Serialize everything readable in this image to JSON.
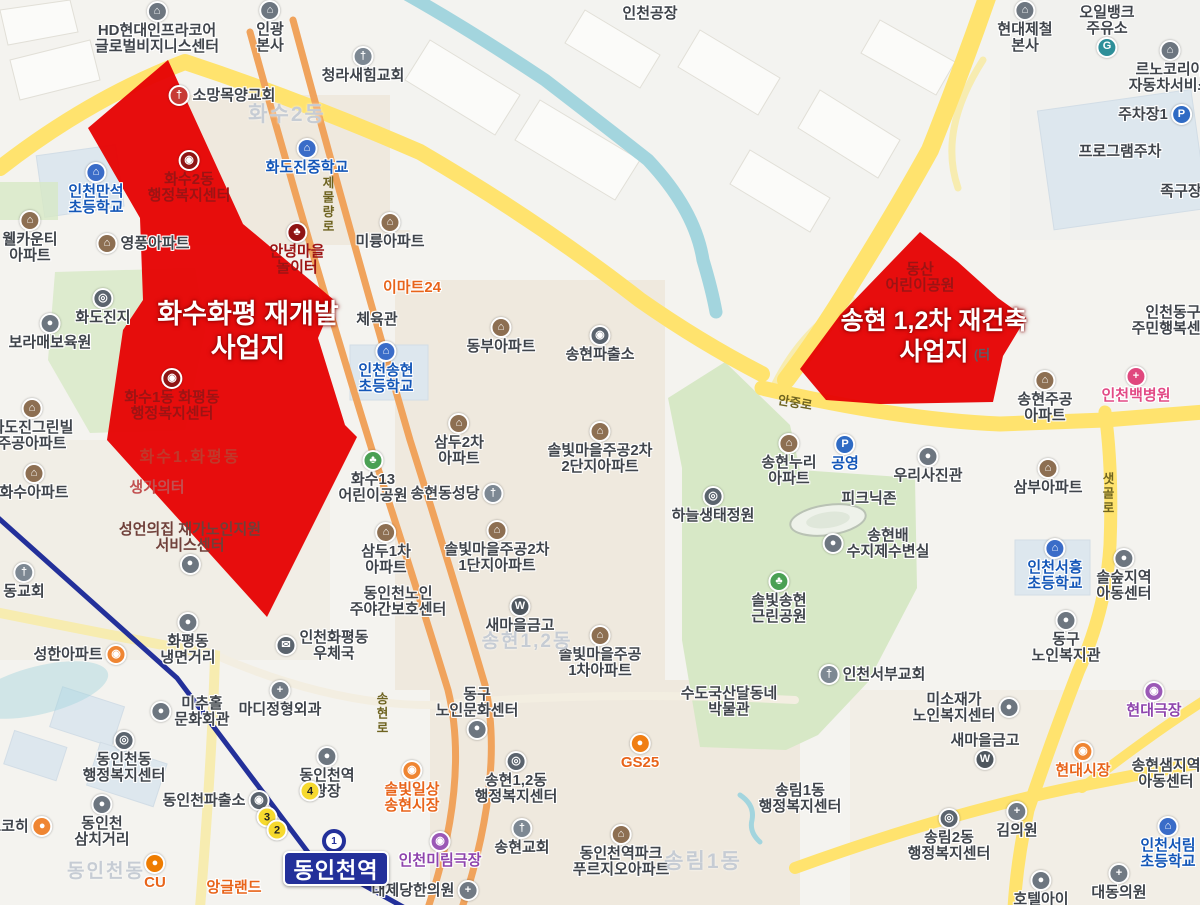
{
  "theme": {
    "zone_red": "#e60505",
    "road_main": "#ffe36e",
    "road_ramp": "#f7ecb0",
    "railway_orange": "#f0a35c",
    "subway_navy": "#23309a",
    "water": "#a3d5de",
    "park": "#d7e8c6"
  },
  "zones": [
    {
      "id": "hwasu-hwapyeong",
      "title_lines": [
        "화수화평 재개발",
        "사업지"
      ],
      "x": 248,
      "y": 298,
      "size": 27
    },
    {
      "id": "songhyeon-12",
      "title_lines": [
        "송현 1,2차 재건축",
        "사업지"
      ],
      "x": 934,
      "y": 306,
      "size": 25
    }
  ],
  "station": {
    "label": "동인천역",
    "line_mark": "1"
  },
  "subway_exits": [
    {
      "n": "4",
      "x": 310,
      "y": 791
    },
    {
      "n": "3",
      "x": 267,
      "y": 817
    },
    {
      "n": "2",
      "x": 277,
      "y": 830
    }
  ],
  "districts": [
    {
      "t": "화수2동",
      "x": 287,
      "y": 98,
      "s": 21
    },
    {
      "t": "송현1,2동",
      "x": 527,
      "y": 626,
      "s": 19
    },
    {
      "t": "송림1동",
      "x": 703,
      "y": 845,
      "s": 21
    },
    {
      "t": "동인천동",
      "x": 106,
      "y": 856,
      "s": 19
    },
    {
      "t": "화수1.화평동",
      "x": 190,
      "y": 443,
      "s": 16,
      "onred": true
    }
  ],
  "road_labels": [
    {
      "t": "제물량로",
      "x": 318,
      "y": 176,
      "v": 1
    },
    {
      "t": "안중로",
      "x": 778,
      "y": 392,
      "r": 10
    },
    {
      "t": "샛골로",
      "x": 1098,
      "y": 472,
      "v": 1
    },
    {
      "t": "송현로",
      "x": 372,
      "y": 692,
      "v": 1
    }
  ],
  "icons": {
    "apt": {
      "bg": "#8d6f52",
      "g": "⌂"
    },
    "sch": {
      "bg": "#3a6cc8",
      "g": "⌂"
    },
    "chu": {
      "bg": "#7d8893",
      "g": "†"
    },
    "chur": {
      "bg": "#c73a35",
      "g": "†"
    },
    "gov": {
      "bg": "#5b646e",
      "g": "◎"
    },
    "govr": {
      "bg": "#8f1414",
      "g": "◉"
    },
    "par": {
      "bg": "#4aa054",
      "g": "♣"
    },
    "parr": {
      "bg": "#8f1414",
      "g": "♣"
    },
    "pol": {
      "bg": "#5b646e",
      "g": "◉"
    },
    "hos": {
      "bg": "#717a84",
      "g": "+"
    },
    "hosp": {
      "bg": "#e0487e",
      "g": "+"
    },
    "pk": {
      "bg": "#2f6bc4",
      "g": "P"
    },
    "w": {
      "bg": "#4e565e",
      "g": "W"
    },
    "mkt": {
      "bg": "#ef8532",
      "g": "◉"
    },
    "thr": {
      "bg": "#9b59b6",
      "g": "◉"
    },
    "gas": {
      "bg": "#2e8f99",
      "g": "G"
    },
    "biz": {
      "bg": "#6d7680",
      "g": "⌂"
    },
    "dot": {
      "bg": "#6d7680",
      "g": "●"
    },
    "post": {
      "bg": "#5b646e",
      "g": "✉"
    },
    "cofe": {
      "bg": "#ef8532",
      "g": "●"
    },
    "cu": {
      "bg": "#ee7c00",
      "g": "●"
    },
    "gs": {
      "bg": "#f07e13",
      "g": "●"
    }
  },
  "pois": [
    {
      "t": [
        "HD현대인프라코어",
        "글로벌비지니스센터"
      ],
      "x": 157,
      "y": 1,
      "c": "d",
      "i": "biz",
      "p": "t"
    },
    {
      "t": [
        "인광",
        "본사"
      ],
      "x": 270,
      "y": 0,
      "c": "d",
      "i": "biz",
      "p": "t"
    },
    {
      "t": [
        "청라새힘교회"
      ],
      "x": 363,
      "y": 46,
      "c": "d",
      "i": "chu",
      "p": "t"
    },
    {
      "t": [
        "인천공장"
      ],
      "x": 650,
      "y": 6,
      "c": "d",
      "i": "",
      "p": "n"
    },
    {
      "t": [
        "현대제철",
        "본사"
      ],
      "x": 1025,
      "y": 0,
      "c": "d",
      "i": "biz",
      "p": "t"
    },
    {
      "t": [
        "오일뱅크",
        "주유소"
      ],
      "x": 1107,
      "y": 5,
      "c": "d",
      "i": "gas",
      "p": "b"
    },
    {
      "t": [
        "르노코리아",
        "자동차서비스"
      ],
      "x": 1170,
      "y": 40,
      "c": "d",
      "i": "biz",
      "p": "t"
    },
    {
      "t": [
        "주차장1"
      ],
      "x": 1155,
      "y": 104,
      "c": "d",
      "i": "pk",
      "p": "r"
    },
    {
      "t": [
        "프로그램주차"
      ],
      "x": 1120,
      "y": 144,
      "c": "d",
      "i": "",
      "p": "n"
    },
    {
      "t": [
        "족구장"
      ],
      "x": 1181,
      "y": 184,
      "c": "d",
      "i": "",
      "p": "n"
    },
    {
      "t": [
        "소망목양교회"
      ],
      "x": 222,
      "y": 85,
      "c": "d",
      "i": "chur",
      "p": "l"
    },
    {
      "t": [
        "인천만석",
        "초등학교"
      ],
      "x": 96,
      "y": 162,
      "c": "b",
      "i": "sch",
      "p": "t"
    },
    {
      "t": [
        "화도진중학교"
      ],
      "x": 307,
      "y": 138,
      "c": "b",
      "i": "sch",
      "p": "t"
    },
    {
      "t": [
        "화수2동",
        "행정복지센터"
      ],
      "x": 189,
      "y": 150,
      "c": "r",
      "i": "govr",
      "p": "t",
      "nh": 1
    },
    {
      "t": [
        "영풍아파트"
      ],
      "x": 143,
      "y": 233,
      "c": "d",
      "i": "apt",
      "p": "l"
    },
    {
      "t": [
        "웰카운티",
        "아파트"
      ],
      "x": 30,
      "y": 210,
      "c": "d",
      "i": "apt",
      "p": "t"
    },
    {
      "t": [
        "미륭아파트"
      ],
      "x": 390,
      "y": 212,
      "c": "d",
      "i": "apt",
      "p": "t"
    },
    {
      "t": [
        "안녕마을",
        "놀이터"
      ],
      "x": 297,
      "y": 222,
      "c": "r",
      "i": "parr",
      "p": "t",
      "nh": 1
    },
    {
      "t": [
        "이마트24"
      ],
      "x": 412,
      "y": 280,
      "c": "o",
      "i": "",
      "p": "n"
    },
    {
      "t": [
        "화도진지"
      ],
      "x": 103,
      "y": 288,
      "c": "d",
      "i": "gov",
      "p": "t"
    },
    {
      "t": [
        "보라매보육원"
      ],
      "x": 50,
      "y": 313,
      "c": "d",
      "i": "dot",
      "p": "t"
    },
    {
      "t": [
        "체육관"
      ],
      "x": 377,
      "y": 312,
      "c": "d",
      "i": "",
      "p": "n"
    },
    {
      "t": [
        "동부아파트"
      ],
      "x": 501,
      "y": 317,
      "c": "d",
      "i": "apt",
      "p": "t"
    },
    {
      "t": [
        "송현파출소"
      ],
      "x": 600,
      "y": 325,
      "c": "d",
      "i": "pol",
      "p": "t"
    },
    {
      "t": [
        "인천송현",
        "초등학교"
      ],
      "x": 386,
      "y": 341,
      "c": "b",
      "i": "sch",
      "p": "t"
    },
    {
      "t": [
        "화도진그린빌",
        "주공아파트"
      ],
      "x": 32,
      "y": 398,
      "c": "d",
      "i": "apt",
      "p": "t"
    },
    {
      "t": [
        "인천동구",
        "주민행복센터"
      ],
      "x": 1173,
      "y": 305,
      "c": "d",
      "i": "",
      "p": "n"
    },
    {
      "t": [
        "인천백병원"
      ],
      "x": 1136,
      "y": 366,
      "c": "pk",
      "i": "hosp",
      "p": "t"
    },
    {
      "t": [
        "송현주공",
        "아파트"
      ],
      "x": 1045,
      "y": 370,
      "c": "d",
      "i": "apt",
      "p": "t"
    },
    {
      "t": [
        "(터"
      ],
      "x": 982,
      "y": 348,
      "c": "g",
      "i": "",
      "p": "n",
      "nh": 1,
      "s": 13
    },
    {
      "t": [
        "동산",
        "어린이공원"
      ],
      "x": 920,
      "y": 262,
      "c": "r",
      "i": "",
      "p": "n",
      "nh": 1
    },
    {
      "t": [
        "화수1동 화평동",
        "행정복지센터"
      ],
      "x": 172,
      "y": 368,
      "c": "r",
      "i": "govr",
      "p": "t",
      "nh": 1
    },
    {
      "t": [
        "생가의터"
      ],
      "x": 157,
      "y": 480,
      "c": "fr",
      "i": "",
      "p": "n",
      "nh": 1
    },
    {
      "t": [
        "삼두2차",
        "아파트"
      ],
      "x": 459,
      "y": 413,
      "c": "d",
      "i": "apt",
      "p": "t"
    },
    {
      "t": [
        "솔빛마을주공2차",
        "2단지아파트"
      ],
      "x": 600,
      "y": 421,
      "c": "d",
      "i": "apt",
      "p": "t"
    },
    {
      "t": [
        "송현누리",
        "아파트"
      ],
      "x": 789,
      "y": 433,
      "c": "d",
      "i": "apt",
      "p": "t"
    },
    {
      "t": [
        "공영"
      ],
      "x": 845,
      "y": 434,
      "c": "b",
      "i": "pk",
      "p": "t"
    },
    {
      "t": [
        "우리사진관"
      ],
      "x": 928,
      "y": 446,
      "c": "d",
      "i": "dot",
      "p": "t"
    },
    {
      "t": [
        "삼부아파트"
      ],
      "x": 1048,
      "y": 458,
      "c": "d",
      "i": "apt",
      "p": "t"
    },
    {
      "t": [
        "화수아파트"
      ],
      "x": 34,
      "y": 463,
      "c": "d",
      "i": "apt",
      "p": "t"
    },
    {
      "t": [
        "화수13",
        "어린이공원"
      ],
      "x": 373,
      "y": 450,
      "c": "d",
      "i": "par",
      "p": "t"
    },
    {
      "t": [
        "삼두1차",
        "아파트"
      ],
      "x": 386,
      "y": 522,
      "c": "d",
      "i": "apt",
      "p": "t"
    },
    {
      "t": [
        "송현동성당"
      ],
      "x": 457,
      "y": 483,
      "c": "d",
      "i": "chu",
      "p": "r"
    },
    {
      "t": [
        "솔빛마을주공2차",
        "1단지아파트"
      ],
      "x": 497,
      "y": 520,
      "c": "d",
      "i": "apt",
      "p": "t"
    },
    {
      "t": [
        "하늘생태정원"
      ],
      "x": 713,
      "y": 486,
      "c": "d",
      "i": "gov",
      "p": "t"
    },
    {
      "t": [
        "피크닉존"
      ],
      "x": 869,
      "y": 491,
      "c": "d",
      "i": "",
      "p": "n"
    },
    {
      "t": [
        "송현배",
        "수지제수변실"
      ],
      "x": 876,
      "y": 528,
      "c": "d",
      "i": "dot",
      "p": "l"
    },
    {
      "t": [
        "인천서흥",
        "초등학교"
      ],
      "x": 1055,
      "y": 538,
      "c": "b",
      "i": "sch",
      "p": "t"
    },
    {
      "t": [
        "솔숲지역",
        "아동센터"
      ],
      "x": 1124,
      "y": 548,
      "c": "d",
      "i": "dot",
      "p": "t"
    },
    {
      "t": [
        "성언의집 재가노인지원",
        "서비스센터"
      ],
      "x": 190,
      "y": 522,
      "c": "m",
      "i": "dot",
      "p": "b",
      "nh": 1
    },
    {
      "t": [
        "동인천노인",
        "주야간보호센터"
      ],
      "x": 398,
      "y": 586,
      "c": "d",
      "i": "",
      "p": "n"
    },
    {
      "t": [
        "새마을금고"
      ],
      "x": 520,
      "y": 596,
      "c": "d",
      "i": "w",
      "p": "t"
    },
    {
      "t": [
        "솔빛마을주공",
        "1차아파트"
      ],
      "x": 600,
      "y": 625,
      "c": "d",
      "i": "apt",
      "p": "t"
    },
    {
      "t": [
        "솔빛송현",
        "근린공원"
      ],
      "x": 779,
      "y": 571,
      "c": "d",
      "i": "par",
      "p": "t"
    },
    {
      "t": [
        "동구",
        "노인복지관"
      ],
      "x": 1066,
      "y": 610,
      "c": "d",
      "i": "dot",
      "p": "t"
    },
    {
      "t": [
        "인천서부교회"
      ],
      "x": 872,
      "y": 664,
      "c": "d",
      "i": "chu",
      "p": "l"
    },
    {
      "t": [
        "동교회"
      ],
      "x": 24,
      "y": 562,
      "c": "d",
      "i": "chu",
      "p": "t"
    },
    {
      "t": [
        "성한아파트"
      ],
      "x": 80,
      "y": 644,
      "c": "d",
      "i": "mkt",
      "p": "r"
    },
    {
      "t": [
        "화평동",
        "냉면거리"
      ],
      "x": 188,
      "y": 612,
      "c": "d",
      "i": "dot",
      "p": "t"
    },
    {
      "t": [
        "인천화평동",
        "우체국"
      ],
      "x": 322,
      "y": 630,
      "c": "d",
      "i": "post",
      "p": "l"
    },
    {
      "t": [
        "미추홀",
        "문화회관"
      ],
      "x": 190,
      "y": 696,
      "c": "d",
      "i": "dot",
      "p": "l"
    },
    {
      "t": [
        "마디정형외과"
      ],
      "x": 280,
      "y": 680,
      "c": "d",
      "i": "hos",
      "p": "t"
    },
    {
      "t": [
        "동인천동",
        "행정복지센터"
      ],
      "x": 124,
      "y": 730,
      "c": "d",
      "i": "gov",
      "p": "t"
    },
    {
      "t": [
        "동인천역",
        "광장"
      ],
      "x": 327,
      "y": 746,
      "c": "d",
      "i": "dot",
      "p": "t"
    },
    {
      "t": [
        "동인천파출소"
      ],
      "x": 216,
      "y": 790,
      "c": "d",
      "i": "pol",
      "p": "r"
    },
    {
      "t": [
        "동인천",
        "삼치거리"
      ],
      "x": 102,
      "y": 794,
      "c": "d",
      "i": "dot",
      "p": "t"
    },
    {
      "t": [
        "드코히"
      ],
      "x": 20,
      "y": 816,
      "c": "d",
      "i": "cofe",
      "p": "r"
    },
    {
      "t": [
        "CU"
      ],
      "x": 155,
      "y": 853,
      "c": "o",
      "i": "cu",
      "p": "t"
    },
    {
      "t": [
        "앙글랜드"
      ],
      "x": 234,
      "y": 880,
      "c": "o",
      "i": "",
      "p": "n"
    },
    {
      "t": [
        "인천미림극장"
      ],
      "x": 440,
      "y": 831,
      "c": "p",
      "i": "thr",
      "p": "t"
    },
    {
      "t": [
        "솔빛일상",
        "송현시장"
      ],
      "x": 412,
      "y": 760,
      "c": "o",
      "i": "mkt",
      "p": "t"
    },
    {
      "t": [
        "대제당한의원"
      ],
      "x": 425,
      "y": 880,
      "c": "d",
      "i": "hos",
      "p": "r"
    },
    {
      "t": [
        "동구",
        "노인문화센터"
      ],
      "x": 477,
      "y": 687,
      "c": "d",
      "i": "dot",
      "p": "b"
    },
    {
      "t": [
        "송현1,2동",
        "행정복지센터"
      ],
      "x": 516,
      "y": 751,
      "c": "d",
      "i": "gov",
      "p": "t"
    },
    {
      "t": [
        "송현교회"
      ],
      "x": 522,
      "y": 818,
      "c": "d",
      "i": "chu",
      "p": "t"
    },
    {
      "t": [
        "GS25"
      ],
      "x": 640,
      "y": 733,
      "c": "o",
      "i": "gs",
      "p": "t"
    },
    {
      "t": [
        "수도국산달동네",
        "박물관"
      ],
      "x": 729,
      "y": 686,
      "c": "d",
      "i": "",
      "p": "n"
    },
    {
      "t": [
        "동인천역파크",
        "푸르지오아파트"
      ],
      "x": 621,
      "y": 824,
      "c": "d",
      "i": "apt",
      "p": "t"
    },
    {
      "t": [
        "미소재가",
        "노인복지센터"
      ],
      "x": 966,
      "y": 692,
      "c": "d",
      "i": "dot",
      "p": "r"
    },
    {
      "t": [
        "새마을금고"
      ],
      "x": 985,
      "y": 733,
      "c": "d",
      "i": "w",
      "p": "b"
    },
    {
      "t": [
        "현대시장"
      ],
      "x": 1083,
      "y": 741,
      "c": "o",
      "i": "mkt",
      "p": "t"
    },
    {
      "t": [
        "현대극장"
      ],
      "x": 1154,
      "y": 681,
      "c": "p",
      "i": "thr",
      "p": "t"
    },
    {
      "t": [
        "송현샘지역",
        "아동센터"
      ],
      "x": 1166,
      "y": 758,
      "c": "d",
      "i": "",
      "p": "n"
    },
    {
      "t": [
        "송림1동",
        "행정복지센터"
      ],
      "x": 800,
      "y": 783,
      "c": "d",
      "i": "",
      "p": "n"
    },
    {
      "t": [
        "송림2동",
        "행정복지센터"
      ],
      "x": 949,
      "y": 808,
      "c": "d",
      "i": "gov",
      "p": "t"
    },
    {
      "t": [
        "김의원"
      ],
      "x": 1017,
      "y": 801,
      "c": "d",
      "i": "hos",
      "p": "t"
    },
    {
      "t": [
        "호텔아이"
      ],
      "x": 1041,
      "y": 870,
      "c": "d",
      "i": "dot",
      "p": "t"
    },
    {
      "t": [
        "대동의원"
      ],
      "x": 1119,
      "y": 863,
      "c": "d",
      "i": "hos",
      "p": "t"
    },
    {
      "t": [
        "인천서림",
        "초등학교"
      ],
      "x": 1168,
      "y": 816,
      "c": "b",
      "i": "sch",
      "p": "t"
    }
  ]
}
